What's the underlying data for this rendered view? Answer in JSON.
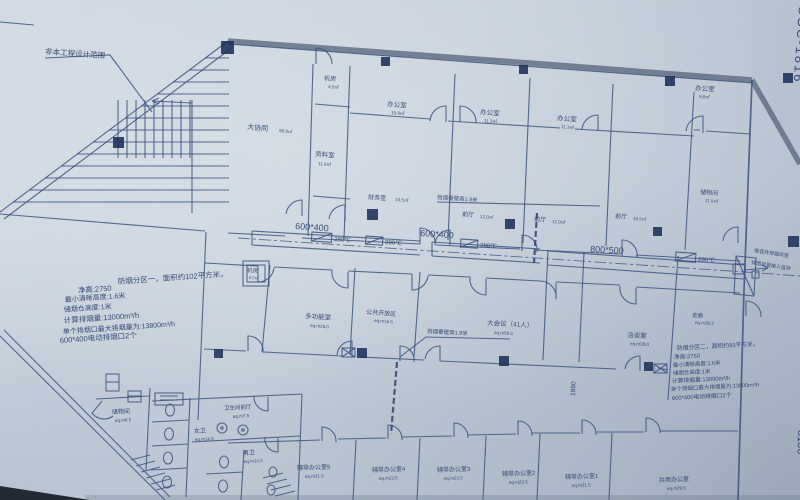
{
  "photo": {
    "sheet_no": "SGC-1816",
    "dim_bottom_right": "8100",
    "dim_shaft": "1880"
  },
  "notes": {
    "out_of_scope": "非本工程设计范围",
    "smoke_curtain_1": "挡烟垂壁高1.8米",
    "smoke_curtain_2": "挡烟垂壁高1.8米",
    "shaft_note_1": "接竖井排烟风管",
    "shaft_note_2": "排烟风管接入竖井"
  },
  "ducts": {
    "d1": "600*400",
    "d2": "600*400",
    "d3": "800*500",
    "damper_label": "280℃"
  },
  "smoke_zone_1": {
    "l1": "防烟分区一，面积约102平方米，",
    "l2": "净高:2750",
    "l3": "最小清晰高度:1.6米",
    "l4": "储烟仓高度:1米",
    "l5": "计算排烟量:13000m³/h",
    "l6": "单个排烟口最大排烟量为:13800m³/h",
    "l7": "600*400电动排烟口2个"
  },
  "smoke_zone_2": {
    "l1": "防烟分区二，面积约93平方米，",
    "l2": "净高:2750",
    "l3": "最小清晰高度:1.6米",
    "l4": "储烟仓高度:1米",
    "l5": "计算排烟量:13000m³/h",
    "l6": "单个排烟口最大排烟量为:13800m³/h",
    "l7": "600*400电动排烟口2个"
  },
  "rooms": [
    {
      "name": "大协同",
      "area": "56.9㎡"
    },
    {
      "name": "机房",
      "area": "4.5㎡"
    },
    {
      "name": "办公室",
      "area": "10.9㎡"
    },
    {
      "name": "办公室",
      "area": "11.3㎡"
    },
    {
      "name": "办公室",
      "area": "11.3㎡"
    },
    {
      "name": "办公室",
      "area": "9.8㎡"
    },
    {
      "name": "资料室",
      "area": "11.9㎡"
    },
    {
      "name": "财务室",
      "area": "10.5㎡"
    },
    {
      "name": "前厅",
      "area": "12.0㎡"
    },
    {
      "name": "前厅",
      "area": "12.0㎡"
    },
    {
      "name": "前厅",
      "area": "10.5㎡"
    },
    {
      "name": "储物间",
      "area": "11.5㎡"
    },
    {
      "name": "机房",
      "area": "6.0㎡"
    },
    {
      "name": "多功能室",
      "area": "eq.m28.0"
    },
    {
      "name": "公共开放区",
      "area": "eq.m16.5"
    },
    {
      "name": "大会议（41人）",
      "area": "eq.m58.5"
    },
    {
      "name": "洽谈室",
      "area": "eq.m28.0"
    },
    {
      "name": "走廊",
      "area": "eq.m36.2"
    },
    {
      "name": "储物间",
      "area": "eq.m6.5"
    },
    {
      "name": "女卫",
      "area": "eq.m14.5"
    },
    {
      "name": "卫生间前厅",
      "area": "eq.m7.5"
    },
    {
      "name": "男卫",
      "area": "eq.m14.5"
    },
    {
      "name": "辅导办公室5",
      "area": "eq.m31.5"
    },
    {
      "name": "辅导办公室4",
      "area": "eq.m23.5"
    },
    {
      "name": "辅导办公室3",
      "area": "eq.m23.5"
    },
    {
      "name": "辅导办公室2",
      "area": "eq.m23.5"
    },
    {
      "name": "辅导办公室1",
      "area": "eq.m31.5"
    },
    {
      "name": "共用办公室",
      "area": "eq.m29.6"
    }
  ]
}
